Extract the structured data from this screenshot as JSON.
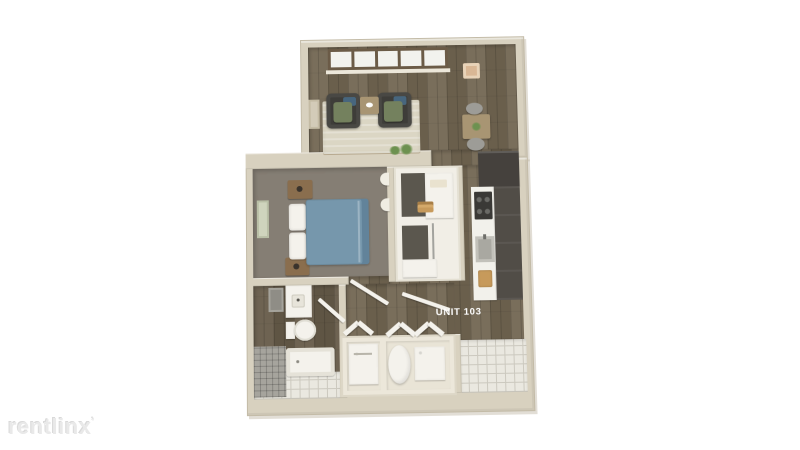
{
  "watermark": {
    "text": "rentlinx",
    "mark": "ʼ"
  },
  "plan": {
    "unit_label": "UNIT 103"
  },
  "legend": {
    "rooms": [
      "living-room",
      "dining-nook",
      "kitchen",
      "bedroom",
      "closet",
      "bathroom",
      "laundry-closet",
      "entry"
    ],
    "furnishings": [
      "armchair",
      "armchair",
      "side-table",
      "area-rug",
      "dining-table",
      "dining-chairs",
      "ceiling-light",
      "window-row",
      "refrigerator",
      "range",
      "kitchen-sink",
      "cutting-board",
      "queen-bed",
      "pillows",
      "nightstands",
      "wall-art",
      "vanity",
      "mirror",
      "toilet",
      "bathtub",
      "washer",
      "water-heater",
      "storage-box",
      "bifold-doors"
    ]
  },
  "palette": {
    "wall": "#d8d1bf",
    "wall-edge": "#c3bba7",
    "wood": "#726652",
    "wood-dark": "#665b49",
    "carpet": "#857e74",
    "rug": "#dbd6c4",
    "bed": "#7697ac",
    "bed-edge": "#62839a",
    "chair": "#3e3d39",
    "cushion": "#74815e",
    "pillow-blue": "#47667e",
    "wood-furn": "#8a6e4e",
    "table": "#a89573",
    "cabinet": "#514d47",
    "fridge": "#45413d",
    "counter": "#f2f1eb",
    "stove": "#3a3936",
    "sink": "#a9a8a1",
    "board": "#c79a5b",
    "tile": "#eae8e0",
    "tile-line": "#ccc9bf",
    "tile-gray": "#a6a49d",
    "laundry-floor": "#e9e4d6",
    "fixture": "#f4f2ec",
    "green": "#6d9150",
    "label": "#ffffff",
    "watermark": "#e9e9e9"
  }
}
